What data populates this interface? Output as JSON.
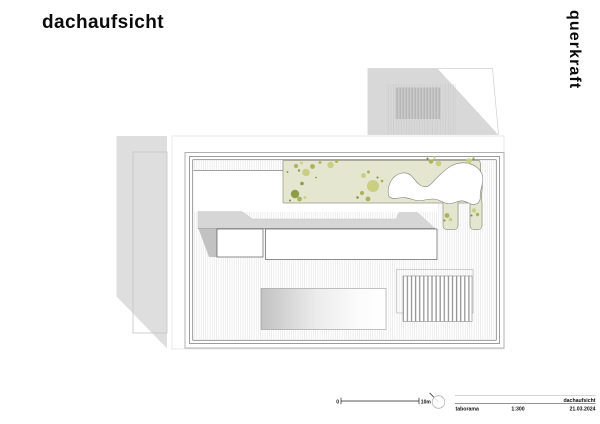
{
  "title": "dachaufsicht",
  "logo": "querkraft",
  "footer": {
    "scale_zero": "0",
    "scale_ten": "10m",
    "project": "taborama",
    "scale_ratio": "1:300",
    "drawing_name": "dachaufsicht",
    "date": "21.03.2024"
  },
  "colors": {
    "green_bg": "#e4e6d0",
    "olive_light": "#c9ce82",
    "olive_mid": "#aab35b",
    "olive_dark": "#8e9c46",
    "olive_dot": "#79873c",
    "neighbor_gray": "#d8d8d8",
    "band_gray": "#d6d6d6",
    "shadow_gray": "#c2c2c2"
  }
}
